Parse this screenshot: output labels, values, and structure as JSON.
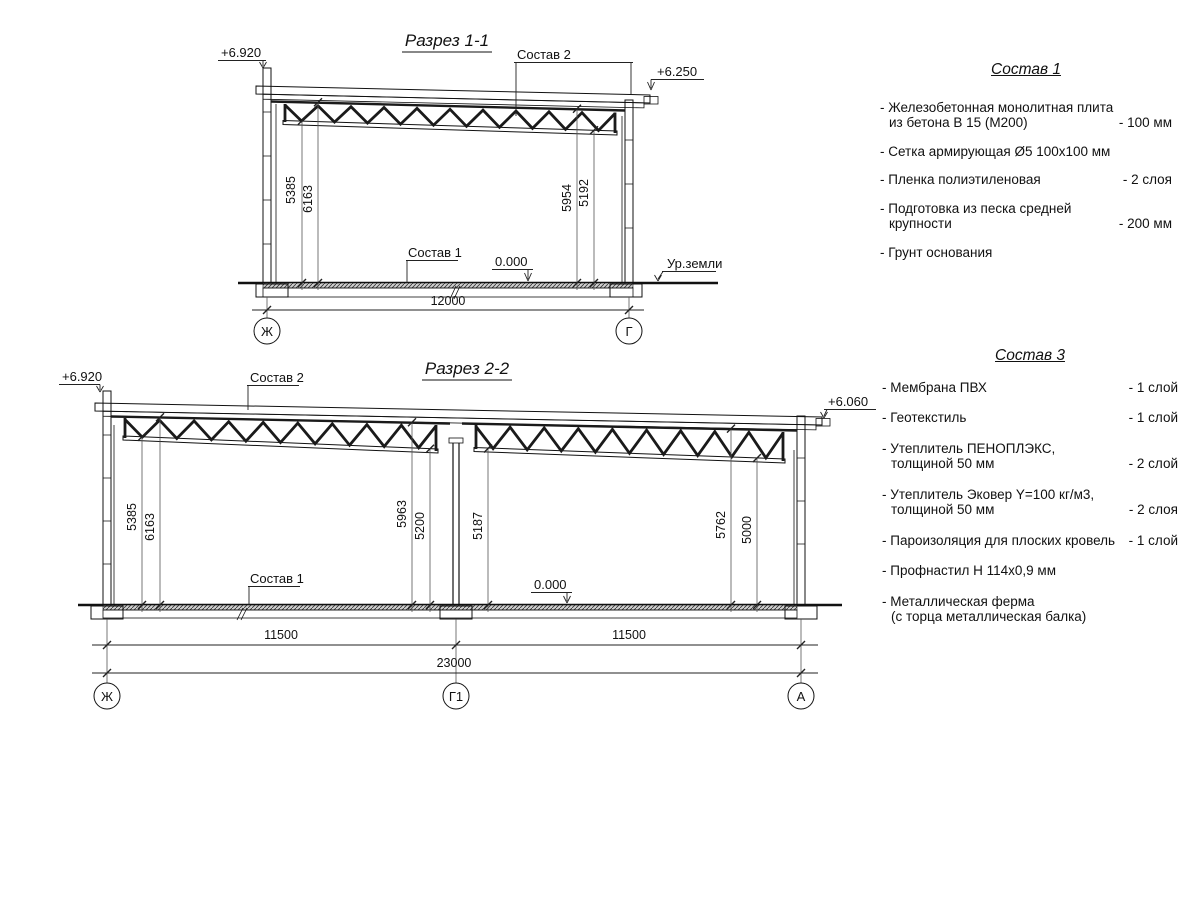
{
  "colors": {
    "ink": "#111111",
    "hatch": "#555555"
  },
  "section1": {
    "title": "Разрез 1-1",
    "elev_left": "+6.920",
    "elev_right": "+6.250",
    "sostav2": "Состав 2",
    "sostav1": "Состав 1",
    "zero": "0.000",
    "ground": "Ур.земли",
    "dim_5385": "5385",
    "dim_6163": "6163",
    "dim_5954": "5954",
    "dim_5192": "5192",
    "span": "12000",
    "axis_left": "Ж",
    "axis_right": "Г"
  },
  "section2": {
    "title": "Разрез 2-2",
    "elev_left": "+6.920",
    "elev_right": "+6.060",
    "sostav2": "Состав 2",
    "sostav1": "Состав 1",
    "zero": "0.000",
    "dim_5385": "5385",
    "dim_6163": "6163",
    "dim_5963": "5963",
    "dim_5200": "5200",
    "dim_5187": "5187",
    "dim_5762": "5762",
    "dim_5000": "5000",
    "span_left": "11500",
    "span_right": "11500",
    "span_total": "23000",
    "axis_left": "Ж",
    "axis_mid": "Г1",
    "axis_right": "А"
  },
  "sostav1_panel": {
    "title": "Состав 1",
    "items": [
      {
        "line1": "- Железобетонная  монолитная плита",
        "line2": "из бетона В 15 (М200)",
        "value": "- 100 мм"
      },
      {
        "line1": "- Сетка армирующая Ø5 100х100 мм",
        "value": ""
      },
      {
        "line1": "- Пленка полиэтиленовая",
        "value": "-  2 слоя"
      },
      {
        "line1": "- Подготовка из песка средней",
        "line2": "крупности",
        "value": "- 200 мм"
      },
      {
        "line1": "- Грунт основания",
        "value": ""
      }
    ]
  },
  "sostav3_panel": {
    "title": "Состав 3",
    "items": [
      {
        "line1": "- Мембрана ПВХ",
        "value": "- 1 слой"
      },
      {
        "line1": "- Геотекстиль",
        "value": "- 1 слой"
      },
      {
        "line1": "- Утеплитель ПЕНОПЛЭКС,",
        "line2": "толщиной 50 мм",
        "value": "- 2 слой"
      },
      {
        "line1": "- Утеплитель Эковер Y=100 кг/м3,",
        "line2": "толщиной 50 мм",
        "value": "- 2 слоя"
      },
      {
        "line1": "- Пароизоляция для плоских кровель",
        "value": "- 1 слой"
      },
      {
        "line1": "- Профнастил Н 114х0,9 мм",
        "value": ""
      },
      {
        "line1": "- Металлическая ферма",
        "line2": "(с торца металлическая балка)",
        "value": ""
      }
    ]
  }
}
